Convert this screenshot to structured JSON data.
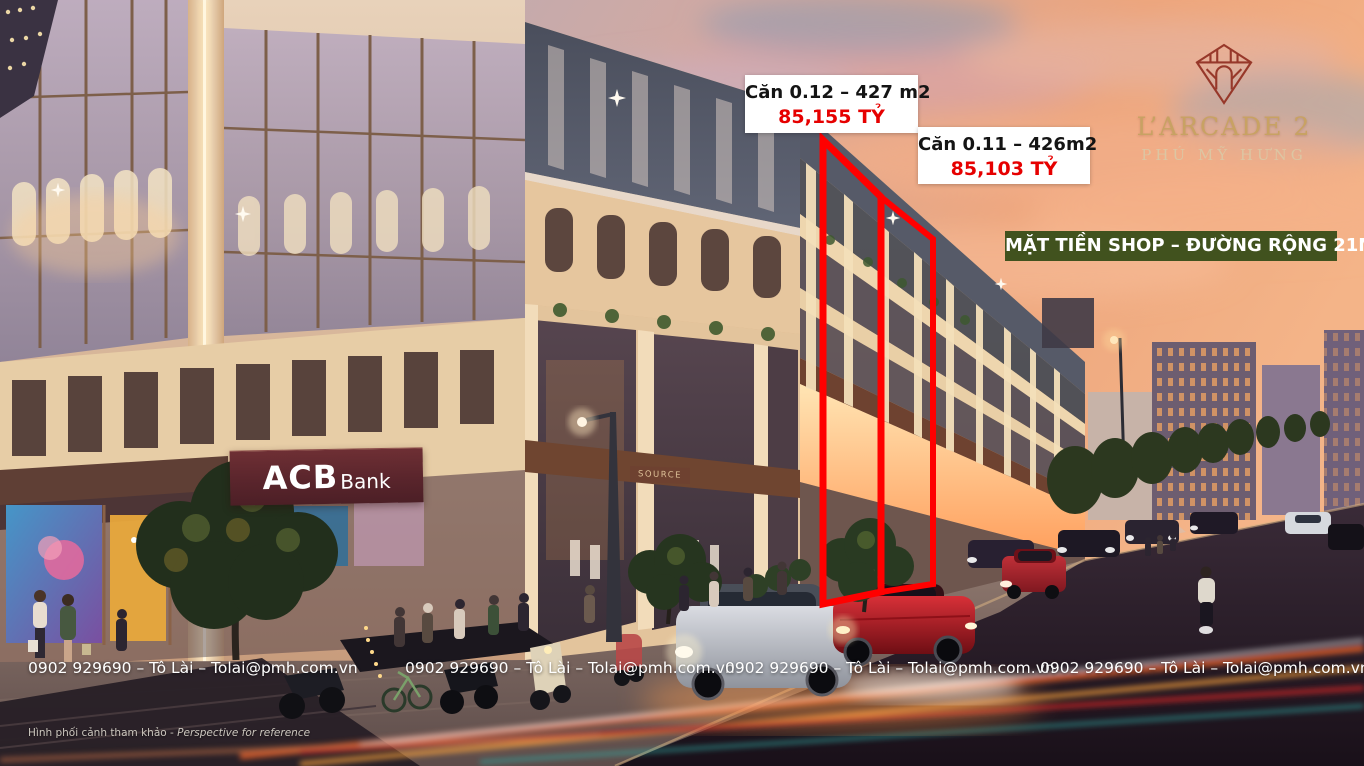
{
  "logo": {
    "title": "L’ARCADE 2",
    "subtitle": "PHÚ MỸ HƯNG",
    "icon": "diamond-arch-emblem",
    "title_color": "#c8a263",
    "subtitle_color": "#dcc6a3",
    "icon_color": "#97382a"
  },
  "banner": {
    "text": "MẶT TIỀN SHOP – ĐƯỜNG RỘNG 21M",
    "bg_color": "#41521e",
    "text_color": "#ffffff"
  },
  "units": [
    {
      "label": "Căn 0.12 – 427 m2",
      "price": "85,155 TỶ",
      "price_color": "#e60000",
      "highlight": "red-outline"
    },
    {
      "label": "Căn 0.11 – 426m2",
      "price": "85,103 TỶ",
      "price_color": "#e60000",
      "highlight": "red-outline"
    }
  ],
  "colors": {
    "highlight_outline": "#ff0000",
    "price_red": "#e60000",
    "banner_bg": "#41521e"
  },
  "contacts": {
    "items": [
      "0902 929690 – Tô Lài – Tolai@pmh.com.vn",
      "0902 929690 – Tô Lài – Tolai@pmh.com.vn",
      "0902 929690 – Tô Lài – Tolai@pmh.com.vn",
      "0902 929690 – Tô Lài – Tolai@pmh.com.vn"
    ]
  },
  "signage": {
    "acb_brand": "ACB",
    "acb_suffix": "Bank",
    "shop_sign": "SOURCE"
  },
  "disclaimer": {
    "vi": "Hình phối cảnh tham khảo - ",
    "en": "Perspective for reference"
  }
}
